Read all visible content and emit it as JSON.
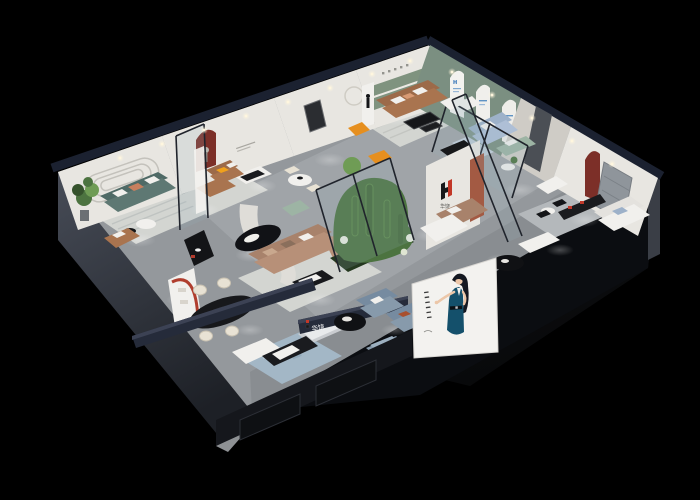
{
  "scene": {
    "background": "#000000"
  },
  "signs": {
    "partition_logo_letter": "H",
    "partition_logo_cjk": "华饶",
    "storefront_sign": "华饶",
    "arch_panel_letter": "H"
  },
  "palette": {
    "bg": "#000000",
    "floor": "#94989c",
    "floorLight": "#aaafb3",
    "wall": "#e8e6e1",
    "wallShade": "#cfccc6",
    "wallDark": "#8f959b",
    "navy": "#252b3a",
    "navyLight": "#3c4254",
    "sage": "#7b8f81",
    "nicheRed": "#7c2f28",
    "terracotta": "#b06a4e",
    "leather": "#a9744f",
    "leatherBack": "#9c6a49",
    "tan": "#b79078",
    "tanBack": "#a8826b",
    "teal": "#5e7873",
    "tealBack": "#4f6a66",
    "slate": "#879aab",
    "paleBlue": "#aebfd6",
    "sageSofa": "#9db4a4",
    "orange": "#e68f1f",
    "yellow": "#f0a11c",
    "plant": "#4c7340",
    "plantLight": "#6f9c55",
    "plantDark": "#35522c",
    "blackF": "#141518",
    "whiteF": "#f1f0ed",
    "cream": "#e8e2d4",
    "rug": "#d3d5d1",
    "rugBlue": "#a3b7c6",
    "glassTint": "rgba(150,180,190,0.18)",
    "glassFrame": "#20242c",
    "grooveLine": "#c4c2bc",
    "posterBg": "#f3f2ef",
    "dress": "#14506b",
    "skin": "#ecc7a9",
    "hair": "#141821",
    "logoRed": "#c23727",
    "logoBlue": "#2a6db5",
    "logoDark": "#17181a",
    "baseLeftTop": "#474c57",
    "baseLeftBottom": "#23262d",
    "baseRight": "#0b0d11"
  }
}
